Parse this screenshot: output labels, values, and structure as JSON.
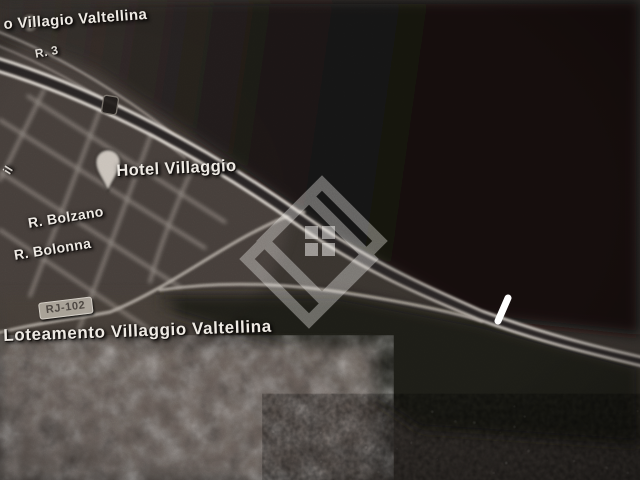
{
  "map": {
    "type": "grayscale-aerial-photo",
    "labels": {
      "area_top": "o Villagio Valtellina",
      "street_r3": "R. 3",
      "street_fragment": "il",
      "hotel": "Hotel Villaggio",
      "street_bolzano": "R. Bolzano",
      "street_bolonna": "R. Bolonna",
      "road_badge": "RJ-102",
      "area_bottom": "Loteamento Villaggio Valtellina"
    },
    "icons": {
      "hotel_pin": "map-pin-icon",
      "poi_dot": "poi-dot-icon",
      "road_marker": "road-marker-icon",
      "watermark": "diamond-house-watermark",
      "highlight": "white-slash-marker"
    },
    "colors": {
      "ground": "#3a3531",
      "dark_area": "#151110",
      "road_light": "#d8d2cb",
      "label_text": "#ece8e2",
      "badge_bg": "#b1aaa1",
      "badge_text": "#4f4944",
      "watermark": "#f7f5f2",
      "highlight": "#ffffff"
    }
  }
}
